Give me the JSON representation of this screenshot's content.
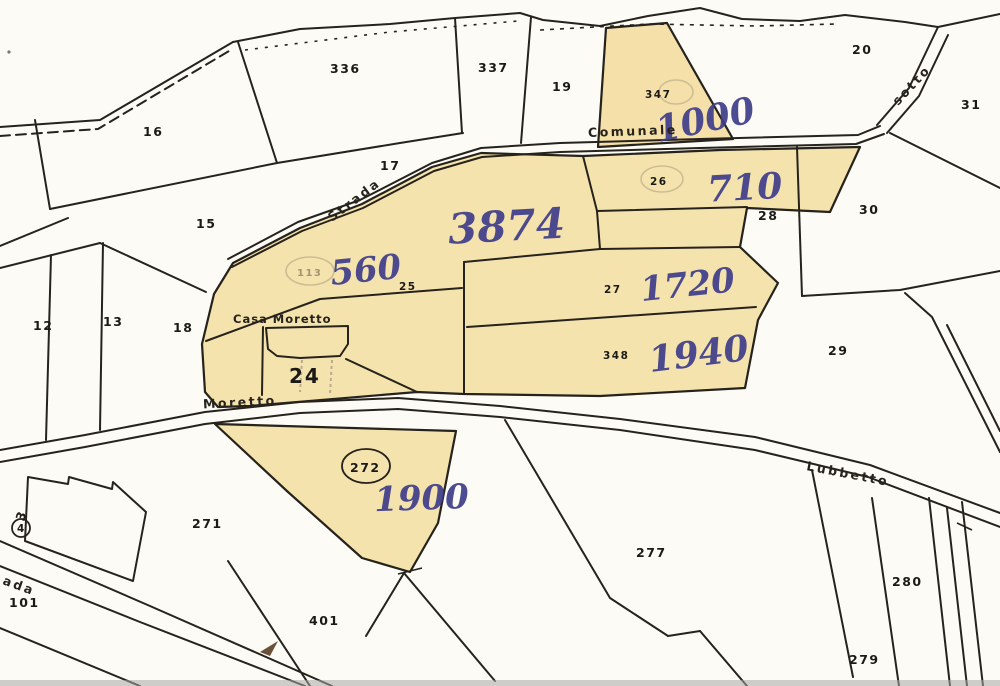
{
  "map": {
    "colors": {
      "background": "#fcfbf5",
      "parcel_shading": "#f4e0a8",
      "line_ink": "#26221c",
      "handwriting_ink": "#3e3e8a",
      "building_hatch": "#9a958d"
    },
    "parcels": {
      "printed": {
        "n336": "336",
        "n337": "337",
        "n19": "19",
        "n347": "347",
        "n20": "20",
        "n31": "31",
        "n16": "16",
        "n17": "17",
        "n26": "26",
        "n28": "28",
        "n30": "30",
        "n15": "15",
        "n25": "25",
        "n27": "27",
        "n12": "12",
        "n13": "13",
        "n18": "18",
        "n348": "348",
        "n29": "29",
        "n24": "24",
        "n272": "272",
        "n271": "271",
        "n277": "277",
        "n101": "101",
        "n280": "280",
        "n401": "401",
        "n279": "279",
        "n113": "113"
      },
      "handwritten_areas": {
        "a1000": "1000",
        "a710": "710",
        "a3874": "3874",
        "a560": "560",
        "a1720": "1720",
        "a1940": "1940",
        "a1900": "1900"
      }
    },
    "roads": {
      "strada": "Strada",
      "comunale": "Comunale",
      "sotto": "sotto",
      "moretto": "Moretto",
      "lubbetto": "Lubbetto",
      "strada_partial": "ada"
    },
    "places": {
      "casa_moretto": "Casa Moretto"
    },
    "markers": {
      "m3": "3",
      "m4": "4"
    }
  }
}
